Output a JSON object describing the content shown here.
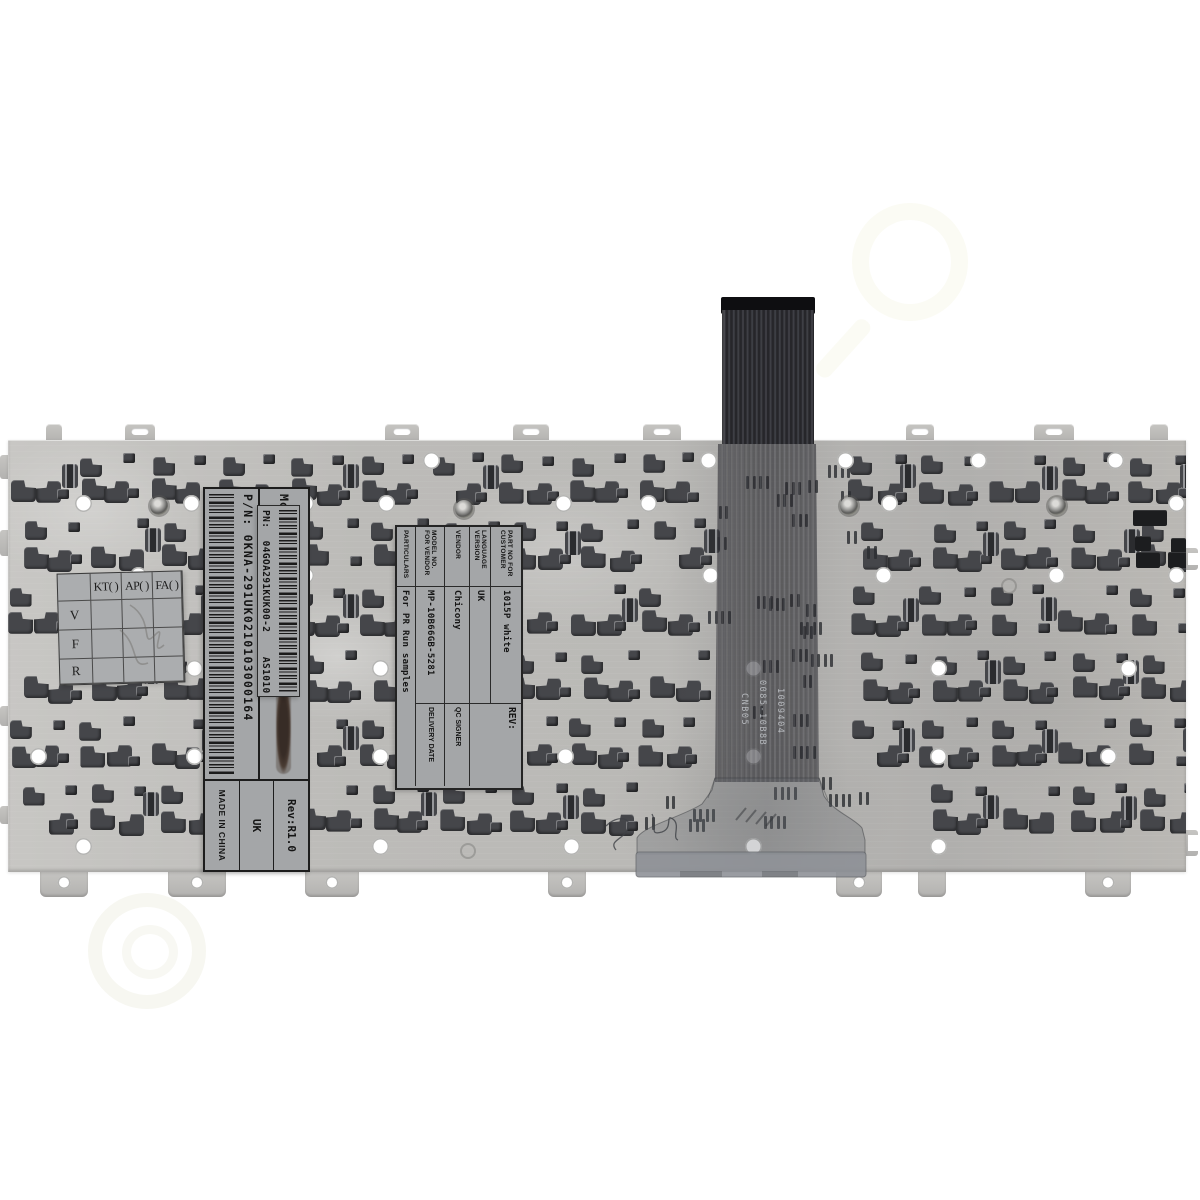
{
  "palette": {
    "background": "#ffffff",
    "plate": "#bcbbb8",
    "plate_highlight": "#c8c7c4",
    "plate_shadow": "#b0afad",
    "clip": "#45464a",
    "label_bg": "#a4a6a8",
    "label_text": "#151515",
    "cable_dark": "#26262a",
    "cable_stripe": "#3e3f45",
    "flap_bar": "#8d9096"
  },
  "stamps": {
    "plate_stamp": "HR#18",
    "cable_stamp_lines": [
      "CNB05",
      "0085-10B8B",
      "1009404"
    ]
  },
  "labels": {
    "model_label": {
      "model_line": "Model: MP-10B66GB-5281",
      "pn_line": "P/N: 0KNA-291UK0210103000164",
      "rev": "Rev:R1.0",
      "region": "UK",
      "origin": "MADE IN CHINA"
    },
    "pn_label": {
      "text": "PN:  04GOA291KUK00-2    AS1010"
    },
    "spec_label": {
      "rows": [
        {
          "field": "PART NO FOR CUSTOMER",
          "value": "1015P white",
          "extra": "REV:"
        },
        {
          "field": "LANGUAGE VERSION",
          "value": "UK",
          "extra": ""
        },
        {
          "field": "VENDOR",
          "value": "Chicony",
          "extra": "QC SIGNER"
        },
        {
          "field": "MODEL NO. FOR VENDOR",
          "value": "MP-10B66GB-5281",
          "extra": "DELIVERY DATE"
        },
        {
          "field": "PARTICULARS",
          "value": "For PR Run samples"
        }
      ]
    },
    "qc_grid": {
      "col_headers": [
        "KT(  )",
        "AP(  )",
        "FA(  )"
      ],
      "row_headers": [
        "V",
        "F",
        "R"
      ]
    }
  }
}
